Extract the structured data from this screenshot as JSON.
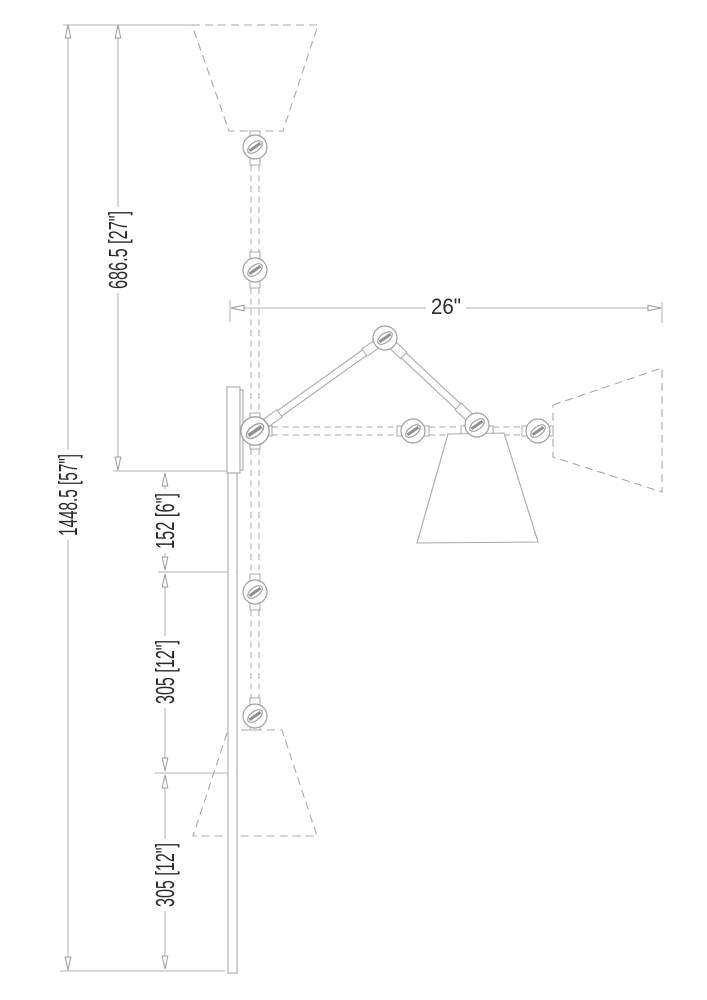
{
  "drawing": {
    "dimensions": {
      "overall_height": "1448.5 [57\"]",
      "upper_height": "686.5 [27\"]",
      "arm_projection": "26\"",
      "plate_gap": "152 [6\"]",
      "upper_spacing": "305 [12\"]",
      "lower_spacing": "305 [12\"]"
    },
    "colors": {
      "line": "#a9a9a9",
      "dimension_line": "#b0b0b0",
      "text": "#2b2b2b",
      "background": "#ffffff"
    }
  }
}
